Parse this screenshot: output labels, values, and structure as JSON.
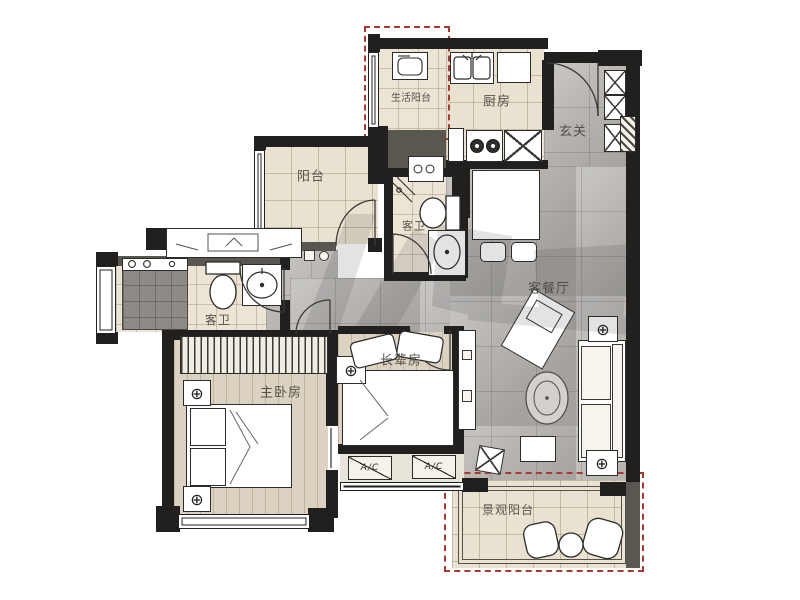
{
  "rooms": {
    "service_balcony": "生活阳台",
    "kitchen": "厨房",
    "foyer": "玄关",
    "balcony": "阳台",
    "bath_upper": "客卫",
    "bath_lower": "客卫",
    "master_bedroom": "主卧房",
    "elder_room": "长辈房",
    "living_dining": "客餐厅",
    "view_balcony": "景观阳台"
  },
  "annotations": {
    "ac": "A/C"
  },
  "icons": {
    "fixture_glyph": "⊕"
  },
  "colors": {
    "wall": "#21201f",
    "dashed_outline": "#a63b30",
    "tile_cream": "#eae2d1",
    "tile_gray": "#b6b3af",
    "wood": "#dcd2c2"
  }
}
